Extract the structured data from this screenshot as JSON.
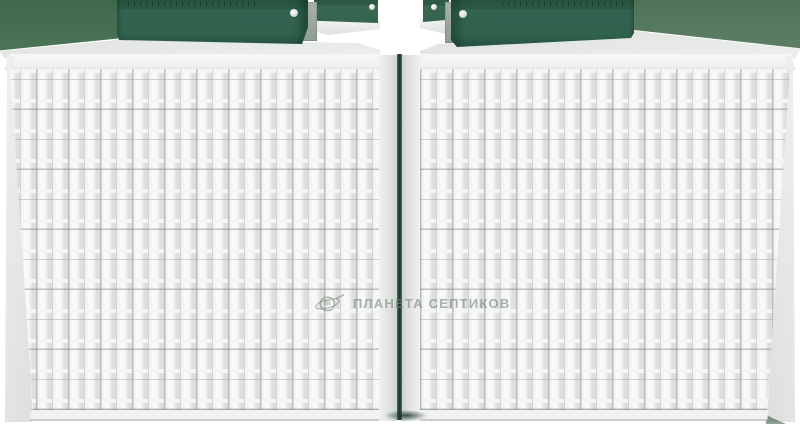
{
  "watermark": {
    "text": "ПЛАНЕТА СЕПТИКОВ",
    "icon": "planet-ring-icon",
    "color": "#74877d"
  },
  "colors": {
    "background": "#ffffff",
    "lid_green": "#2e5d49",
    "lid_green_dark": "#24503e",
    "rear_lid_green": "#39684f",
    "backdrop_green_left": "#487053",
    "backdrop_green_right": "#587a62",
    "hatch_block_gray": "#9aa79d",
    "tank_body_white": "#f0f1ef",
    "panel_shadow_gray": "#d9dcd9",
    "rib_highlight": "#f5f6f4",
    "gap_shadow_green": "#1b392d"
  },
  "objects": {
    "tank_count": 2,
    "front_lid_count": 2,
    "rear_lid_count": 2
  }
}
